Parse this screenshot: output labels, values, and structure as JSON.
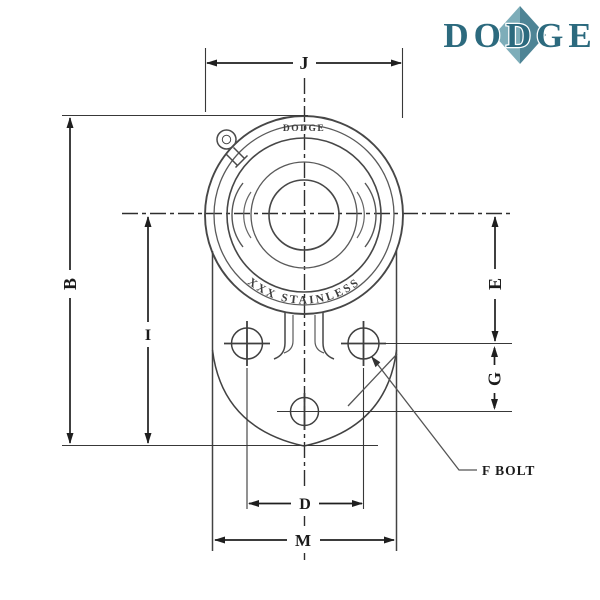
{
  "logo": {
    "text": "DODGE",
    "text_color": "#2c6a7e",
    "diamond_left_color": "#7dadb9",
    "diamond_right_color": "#4e8495"
  },
  "drawing": {
    "cast_top": "DODGE",
    "cast_bottom": "XXX STAINLESS",
    "labels": {
      "flange_width": "J",
      "overall_height": "B",
      "center_to_base": "I",
      "center_to_bolt_line": "E",
      "bolt_line_to_lower_bolt": "G",
      "bolt_spacing": "D",
      "overall_width": "M",
      "bolt_callout": "F BOLT"
    }
  }
}
